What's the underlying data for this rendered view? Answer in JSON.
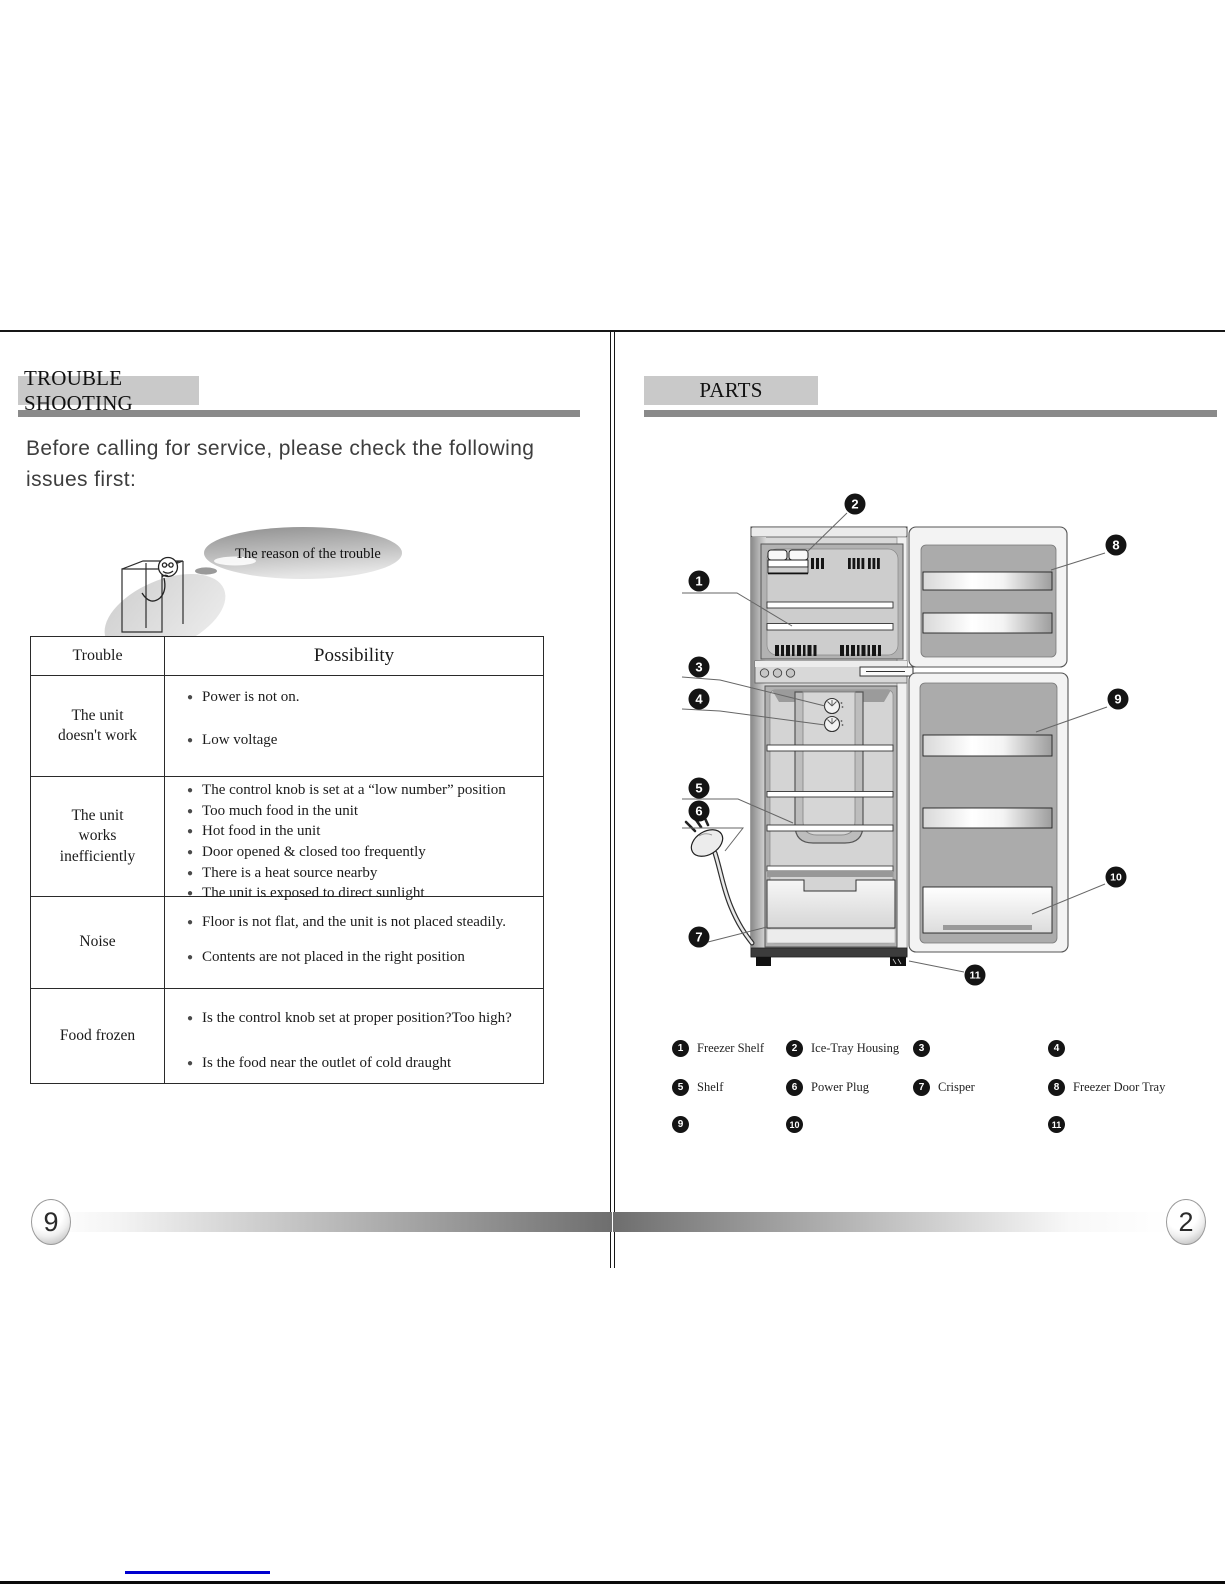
{
  "pages": {
    "left": {
      "page_number": "9",
      "heading": "TROUBLE SHOOTING",
      "intro_lines": [
        "Before calling  for service, please check the following",
        "issues first:"
      ],
      "bubble": "The reason of the trouble",
      "table": {
        "headers": [
          "Trouble",
          "Possibility"
        ],
        "rows": [
          {
            "trouble": "The unit doesn't work",
            "possibilities": [
              "Power is not on.",
              "Low voltage"
            ]
          },
          {
            "trouble": "The unit works inefficiently",
            "possibilities": [
              "The control knob is set at a “low number”  position",
              "Too much food in the unit",
              "Hot food in the unit",
              "Door opened & closed too frequently",
              "There is a heat source nearby",
              "The unit is exposed to direct sunlight"
            ]
          },
          {
            "trouble": "Noise",
            "possibilities": [
              "Floor is not flat, and the unit is not placed steadily.",
              "Contents are not placed in the right position"
            ]
          },
          {
            "trouble": "Food frozen",
            "possibilities": [
              "Is the control knob set at proper position?Too high?",
              "Is the food near the outlet of cold draught"
            ]
          }
        ]
      }
    },
    "right": {
      "page_number": "2",
      "heading": "PARTS",
      "callouts": [
        "1",
        "2",
        "3",
        "4",
        "5",
        "6",
        "7",
        "8",
        "9",
        "10",
        "11"
      ],
      "legend_rows": [
        [
          {
            "num": "1",
            "label": "Freezer Shelf"
          },
          {
            "num": "2",
            "label": "Ice-Tray Housing"
          },
          {
            "num": "3",
            "label": ""
          },
          {
            "num": "4",
            "label": ""
          }
        ],
        [
          {
            "num": "5",
            "label": "Shelf"
          },
          {
            "num": "6",
            "label": "Power  Plug"
          },
          {
            "num": "7",
            "label": "Crisper"
          },
          {
            "num": "8",
            "label": "Freezer Door Tray"
          }
        ],
        [
          {
            "num": "9",
            "label": ""
          },
          {
            "num": "10",
            "label": ""
          },
          null,
          {
            "num": "11",
            "label": ""
          }
        ]
      ]
    }
  },
  "colors": {
    "heading_bg": "#c9c9c9",
    "rule_gray": "#8a8a8a",
    "link_blue": "#0000cf",
    "callout_black": "#141414"
  }
}
